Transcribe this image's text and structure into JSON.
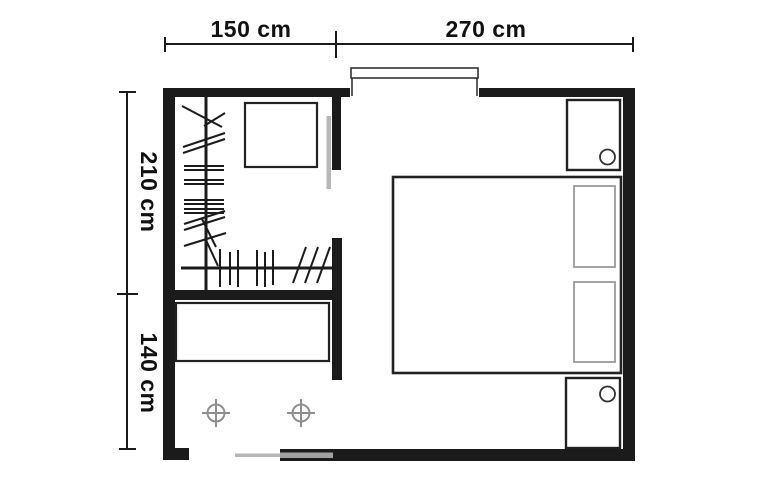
{
  "figure": {
    "type": "floor-plan",
    "symbols": [
      "wall",
      "window",
      "sliding-door",
      "clothes-rail",
      "hanger-marks",
      "wardrobe-box",
      "dresser",
      "double-bed",
      "pillow",
      "nightstand",
      "lamp",
      "ceiling-light"
    ]
  },
  "dimensions": {
    "top_left": "150 cm",
    "top_right": "270 cm",
    "left_upper": "210 cm",
    "left_lower": "140 cm"
  },
  "colors": {
    "background": "#ffffff",
    "wall": "#1b1b1b",
    "outline": "#222222",
    "dim_line": "#1a1a1a",
    "label": "#111111",
    "sliding_door_gray": "#b7b7b7",
    "pocket_door_gray": "#a0a0a0",
    "pillow_gray": "#9a9a9a",
    "light_gray": "#8f8f8f"
  }
}
